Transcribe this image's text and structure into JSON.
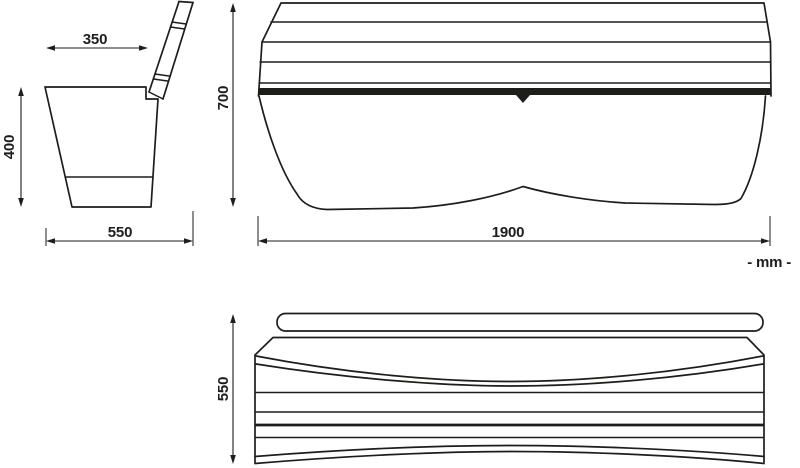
{
  "drawing": {
    "background_color": "#ffffff",
    "line_color": "#1d1d1b",
    "unit_label": "- mm -",
    "side_view": {
      "seat_top_depth": "350",
      "seat_height": "400",
      "overall_depth": "550",
      "overall_height": "700"
    },
    "front_view": {
      "overall_length": "1900"
    },
    "plan_view": {
      "overall_depth": "550"
    }
  }
}
